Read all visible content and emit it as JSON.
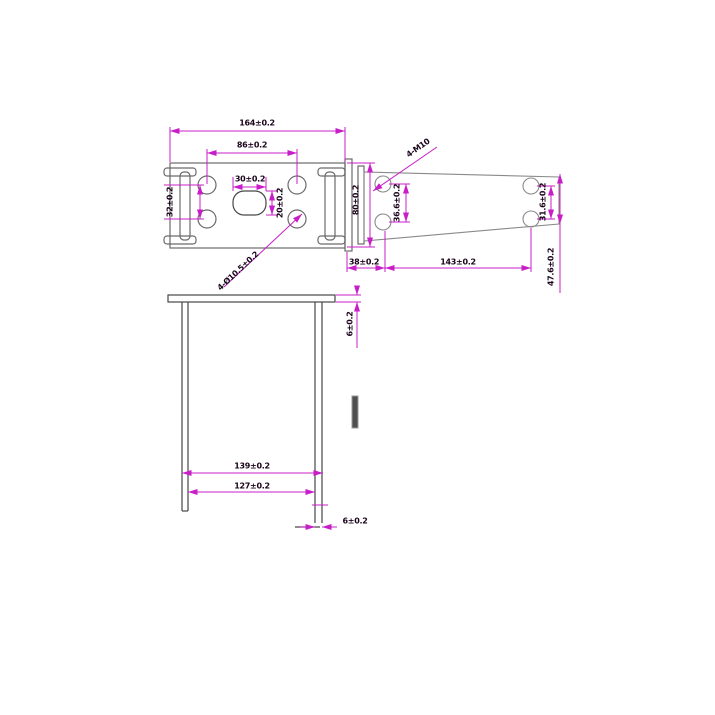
{
  "colors": {
    "dimension_line": "#c81ec8",
    "outline": "#6a6a6a",
    "outline_dark": "#474747",
    "text": "#1c051c",
    "background": "#ffffff"
  },
  "top_view": {
    "overall_width": "164±0.2",
    "hole_pitch": "86±0.2",
    "slot_width": "30±0.2",
    "slot_height": "20±0.2",
    "hole_pitch_vertical": "32±0.2",
    "holes_note": "4-Ø10.5±0.2"
  },
  "side_view": {
    "bracket_height": "80±0.2",
    "thread_note": "4-M10",
    "left_hole_pitch": "36.6±0.2",
    "right_hole_pitch": "31.6±0.2",
    "end_height": "47.6±0.2",
    "bracket_to_hole": "38±0.2",
    "hole_span": "143±0.2"
  },
  "front_view": {
    "plate_thickness": "6±0.2",
    "outer_leg_span": "139±0.2",
    "inner_leg_span": "127±0.2",
    "leg_thickness": "6±0.2"
  }
}
